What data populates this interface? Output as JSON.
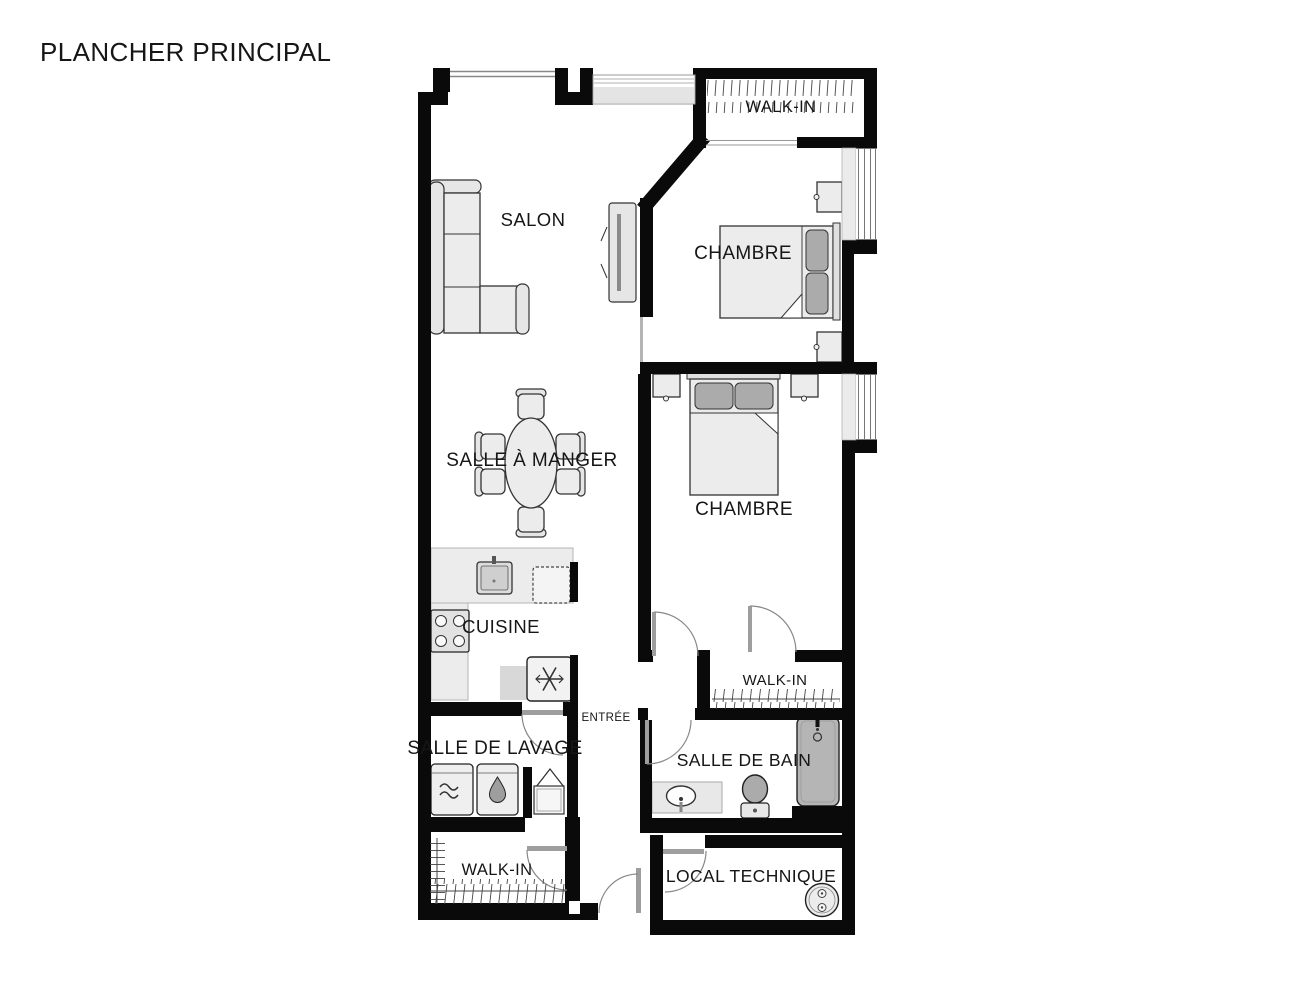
{
  "title": "PLANCHER PRINCIPAL",
  "rooms": {
    "salon": {
      "label": "SALON"
    },
    "walk_in_top": {
      "label": "WALK-IN"
    },
    "chambre_1": {
      "label": "CHAMBRE"
    },
    "chambre_2": {
      "label": "CHAMBRE"
    },
    "salle_a_manger": {
      "label": "SALLE À MANGER"
    },
    "cuisine": {
      "label": "CUISINE"
    },
    "entree": {
      "label": "ENTRÉE"
    },
    "salle_de_lavage": {
      "label": "SALLE DE LAVAGE"
    },
    "walk_in_laundry": {
      "label": "WALK-IN"
    },
    "walk_in_hall": {
      "label": "WALK-IN"
    },
    "salle_de_bain": {
      "label": "SALLE DE BAIN"
    },
    "local_technique": {
      "label": "LOCAL TECHNIQUE"
    }
  },
  "fixtures": {
    "salon": [
      "sectional-sofa-icon",
      "tv-icon"
    ],
    "salle_a_manger": [
      "oval-dining-table-icon",
      "dining-chair-icon"
    ],
    "cuisine": [
      "kitchen-sink-icon",
      "dishwasher-icon",
      "stove-burners-icon",
      "fridge-snowflake-icon"
    ],
    "chambre_1": [
      "double-bed-icon",
      "nightstand-icon"
    ],
    "chambre_2": [
      "double-bed-icon",
      "nightstand-icon"
    ],
    "salle_de_lavage": [
      "washer-wave-icon",
      "dryer-drop-icon",
      "closet-chevron-icon"
    ],
    "salle_de_bain": [
      "bathtub-faucet-icon",
      "toilet-icon",
      "vanity-sink-icon"
    ],
    "local_technique": [
      "water-heater-icon"
    ],
    "walk_ins": [
      "clothes-rail-hatch-icon"
    ],
    "openings": [
      "door-swing-arc-icon",
      "window-triple-line-icon"
    ]
  },
  "colors": {
    "wall": "#0a0a0a",
    "furniture_fill": "#ececec",
    "furniture_outline": "#333333",
    "pillow": "#ababab",
    "tub": "#b5b5b5",
    "counter": "#ececec",
    "window_line": "#777777",
    "door_arc": "#888888",
    "hatch": "#444444",
    "text": "#161616",
    "background": "#ffffff"
  }
}
